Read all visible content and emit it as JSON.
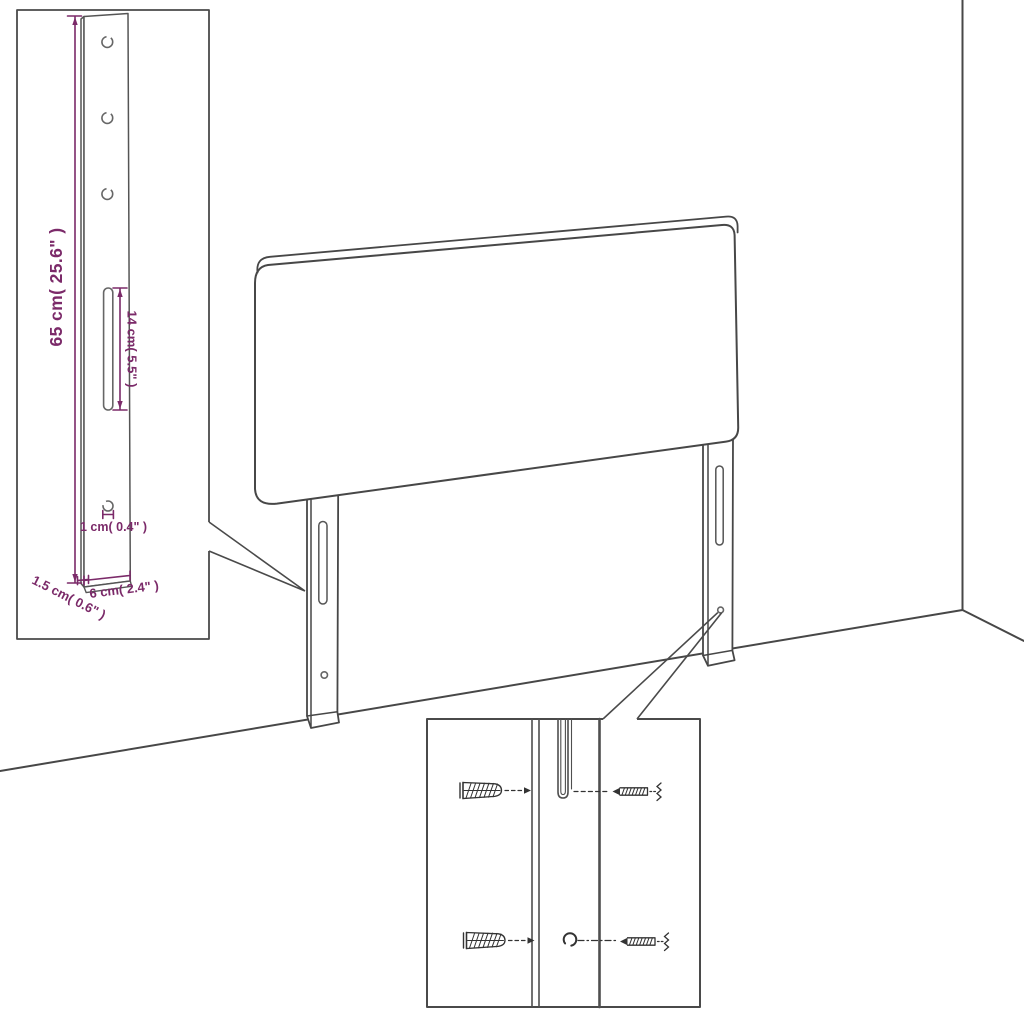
{
  "meta": {
    "type": "furniture-assembly-diagram",
    "subject": "Headboard with mounting legs — dimension and hardware detail diagram"
  },
  "colors": {
    "dimension_text": "#7b2a69",
    "line_art": "#474747"
  },
  "dimensions": {
    "leg_height": "65 cm( 25.6\" )",
    "slot_length": "14 cm( 5.5\" )",
    "hole_diameter": "1 cm( 0.4\" )",
    "leg_thickness": "1.5 cm( 0.6\" )",
    "leg_width": "6 cm( 2.4\" )"
  }
}
